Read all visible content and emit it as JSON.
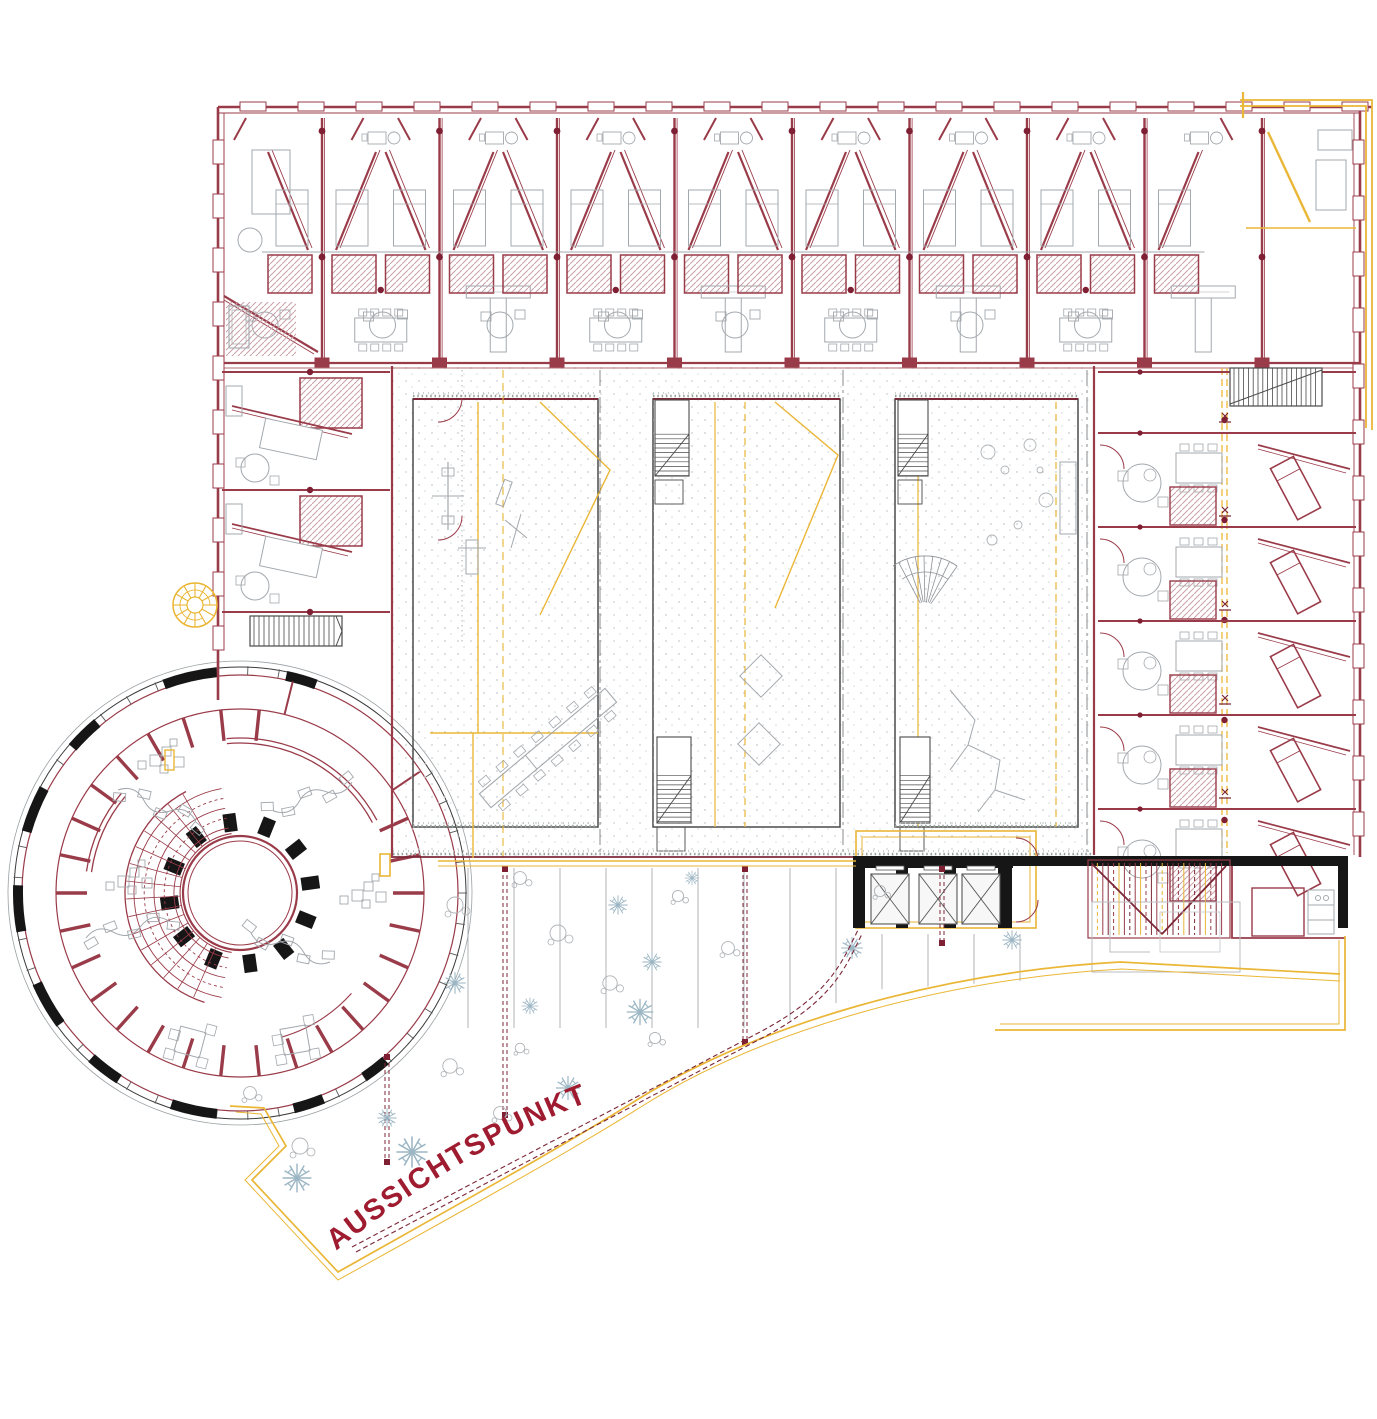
{
  "label": {
    "viewpoint": "AUSSICHTSPUNKT"
  },
  "palette": {
    "wall": "#9a3b49",
    "wall_dark": "#7c2737",
    "dot_red": "#7f1f33",
    "accent_yellow": "#eab636",
    "black": "#161616",
    "dark_gray": "#4a4a4a",
    "furniture_gray": "#a3a8ad",
    "light_gray": "#c3c7cb",
    "plant_blue": "#9cb6c4",
    "grass_green": "#96a49b",
    "label_red": "#9e1b30",
    "hatch_rose": "#c8a2a8"
  }
}
